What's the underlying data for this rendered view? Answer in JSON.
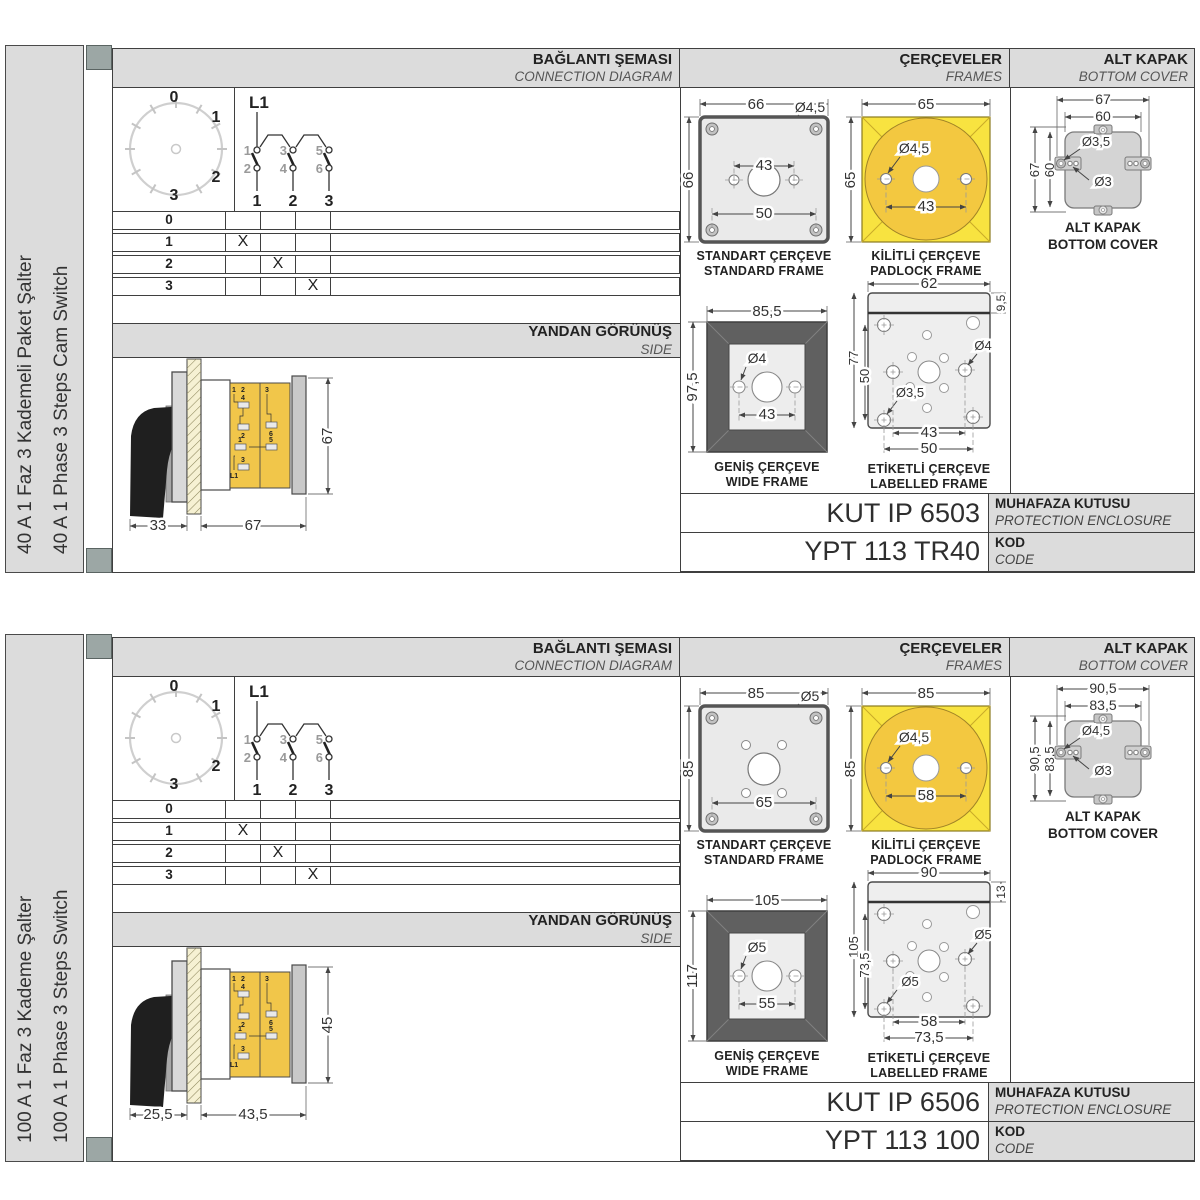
{
  "shared": {
    "hdr": {
      "conn_tr": "BAĞLANTI ŞEMASI",
      "conn_en": "CONNECTION DIAGRAM",
      "frames_tr": "ÇERÇEVELER",
      "frames_en": "FRAMES",
      "cover_tr": "ALT KAPAK",
      "cover_en": "BOTTOM COVER"
    },
    "side": {
      "tr": "YANDAN GÖRÜNÜŞ",
      "en": "SIDE"
    },
    "names": {
      "standard_tr": "STANDART ÇERÇEVE",
      "standard_en": "STANDARD FRAME",
      "padlock_tr": "KİLİTLİ ÇERÇEVE",
      "padlock_en": "PADLOCK FRAME",
      "wide_tr": "GENİŞ ÇERÇEVE",
      "wide_en": "WIDE FRAME",
      "labelled_tr": "ETİKETLİ ÇERÇEVE",
      "labelled_en": "LABELLED FRAME",
      "cover_tr": "ALT KAPAK",
      "cover_en": "BOTTOM COVER",
      "enclosure_tr": "MUHAFAZA KUTUSU",
      "enclosure_en": "PROTECTION ENCLOSURE",
      "code_tr": "KOD",
      "code_en": "CODE"
    },
    "dial": {
      "p0": "0",
      "p1": "1",
      "p2": "2",
      "p3": "3"
    },
    "circuit": {
      "source": "L1",
      "t1": "1",
      "t3": "3",
      "t5": "5",
      "b2": "2",
      "b4": "4",
      "b6": "6",
      "o1": "1",
      "o2": "2",
      "o3": "3"
    },
    "table": {
      "r0": {
        "step": "0",
        "m1": "",
        "m2": "",
        "m3": ""
      },
      "r1": {
        "step": "1",
        "m1": "X",
        "m2": "",
        "m3": ""
      },
      "r2": {
        "step": "2",
        "m1": "",
        "m2": "X",
        "m3": ""
      },
      "r3": {
        "step": "3",
        "m1": "",
        "m2": "",
        "m3": "X"
      }
    },
    "side_terms": {
      "a": "1",
      "b": "2",
      "c": "4",
      "d": "2",
      "e": "3",
      "f": "6",
      "g": "1",
      "h": "5",
      "i": "3",
      "j": "L1"
    }
  },
  "sections": [
    {
      "title_tr": "40 A 1 Faz 3 Kademeli Paket Şalter",
      "title_en": "40 A 1 Phase 3 Steps Cam Switch",
      "side_dims": {
        "handle": "33",
        "body": "67",
        "height": "67"
      },
      "standard": {
        "w": "66",
        "h": "66",
        "hole": "Ø4,5",
        "mid": "43",
        "bottom": "50"
      },
      "padlock": {
        "w": "65",
        "h": "65",
        "hole": "Ø4,5",
        "spacing": "43"
      },
      "wide": {
        "w": "85,5",
        "h": "97,5",
        "hole": "Ø4",
        "spacing": "43"
      },
      "labelled": {
        "w": "62",
        "band": "9,5",
        "h": "77",
        "left": "50",
        "hole_mid": "Ø4",
        "hole_corner": "Ø3,5",
        "bot_inner": "43",
        "bot_outer": "50"
      },
      "cover": {
        "wo": "67",
        "wi": "60",
        "ho": "67",
        "hi": "60",
        "hole_o": "Ø3,5",
        "hole_i": "Ø3"
      },
      "enclosure": "KUT IP 6503",
      "code": "YPT 113 TR40"
    },
    {
      "title_tr": "100 A 1 Faz 3 Kademe Şalter",
      "title_en": "100 A 1 Phase 3 Steps Switch",
      "side_dims": {
        "handle": "25,5",
        "body": "43,5",
        "height": "45"
      },
      "standard": {
        "w": "85",
        "h": "85",
        "hole": "Ø5",
        "mid": "",
        "bottom": "65"
      },
      "padlock": {
        "w": "85",
        "h": "85",
        "hole": "Ø4,5",
        "spacing": "58"
      },
      "wide": {
        "w": "105",
        "h": "117",
        "hole": "Ø5",
        "spacing": "55"
      },
      "labelled": {
        "w": "90",
        "band": "13",
        "h": "105",
        "left": "73,5",
        "hole_mid": "Ø5",
        "hole_corner": "Ø5",
        "bot_inner": "58",
        "bot_outer": "73,5"
      },
      "cover": {
        "wo": "90,5",
        "wi": "83,5",
        "ho": "90,5",
        "hi": "83,5",
        "hole_o": "Ø4,5",
        "hole_i": "Ø3"
      },
      "enclosure": "KUT IP 6506",
      "code": "YPT 113 100"
    }
  ]
}
